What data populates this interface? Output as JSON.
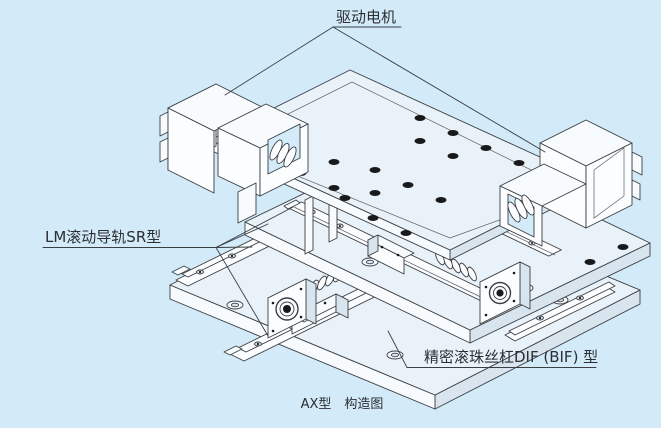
{
  "figure": {
    "caption": "AX型　构造图",
    "labels": {
      "drive_motor": "驱动电机",
      "lm_guide": "LM滚动导轨SR型",
      "ball_screw": "精密滚珠丝杠DIF (BIF) 型"
    },
    "colors": {
      "background": "#d3eaf8",
      "line": "#3a3f44",
      "text": "#2b2f33",
      "hole": "#17191b"
    }
  }
}
